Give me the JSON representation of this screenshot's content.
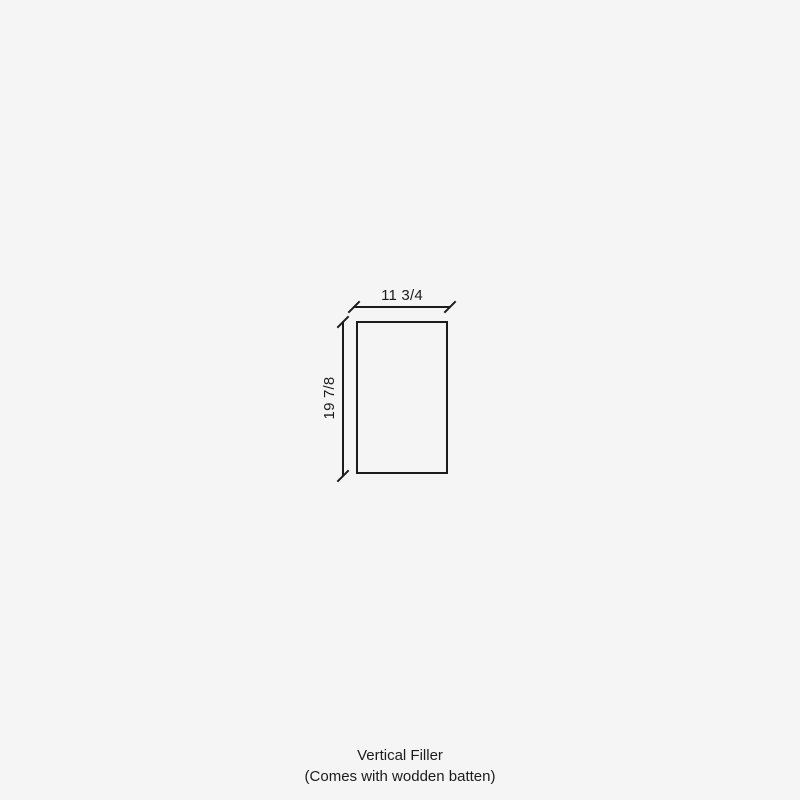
{
  "diagram": {
    "dimensions": {
      "width": {
        "label": "11 3/4"
      },
      "height": {
        "label": "19 7/8"
      }
    },
    "caption": {
      "title": "Vertical Filler",
      "subtitle": "(Comes with wodden batten)"
    },
    "colors": {
      "background": "#f5f5f5",
      "line": "#1c1c1c",
      "text": "#1c1c1c"
    }
  }
}
